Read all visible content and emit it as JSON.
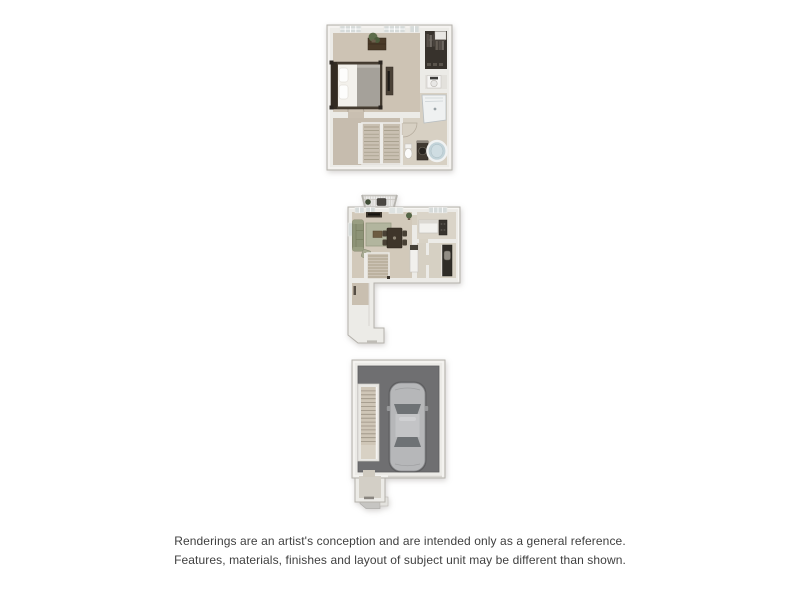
{
  "disclaimer": {
    "line1": "Renderings are an artist's conception and are intended only as a general reference.",
    "line2": "Features, materials, finishes and layout of subject unit may be different than shown."
  },
  "plans": {
    "upper": {
      "name": "upper-floor-plan",
      "features": [
        "bedroom",
        "bed",
        "dresser-with-plant",
        "media-chest",
        "reach-in-closet",
        "stacked-washer-dryer",
        "bathroom",
        "shower",
        "vanity-sink",
        "toilet",
        "bathtub",
        "switchback-staircase",
        "windows"
      ]
    },
    "main": {
      "name": "main-floor-plan",
      "features": [
        "balcony-railing",
        "living-room",
        "sofa",
        "tv-console",
        "area-rug",
        "coffee-table",
        "accent-chair",
        "dining-table-with-chairs",
        "kitchen",
        "kitchen-island",
        "range",
        "counters",
        "staircase",
        "entry-corridor",
        "windows",
        "balcony-door"
      ]
    },
    "garage": {
      "name": "garage-level-plan",
      "features": [
        "garage",
        "car",
        "staircase",
        "entry-vestibule",
        "walkway"
      ]
    }
  },
  "colors": {
    "background": "#ffffff",
    "wall": "#ecebe7",
    "wall_edge": "#b9b6b0",
    "carpet": "#cdc3b4",
    "bath_floor": "#d7d0c3",
    "garage_floor": "#6f6f71",
    "car_body": "#b6b7b9",
    "sofa_green": "#8d9377",
    "rug_sage": "#b2b59e",
    "tub_blue": "#c2d3d9",
    "wood_dark": "#473e33",
    "text": "#3f3f3f"
  }
}
